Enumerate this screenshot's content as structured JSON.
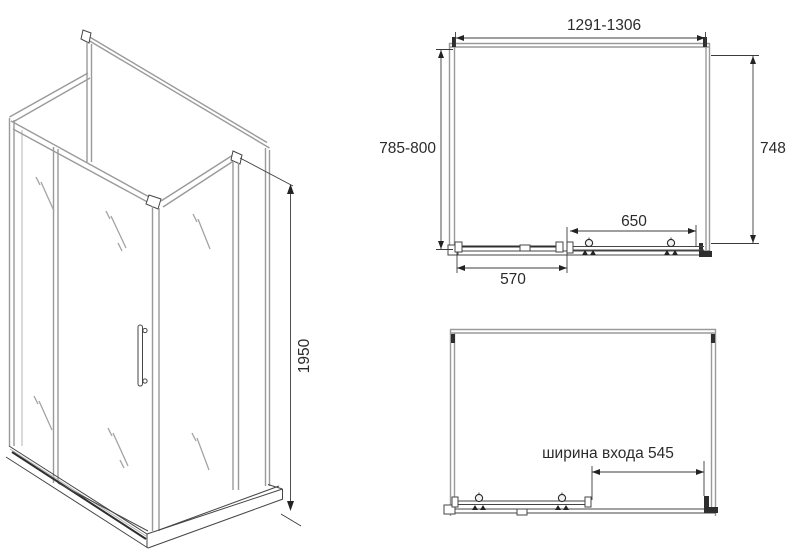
{
  "drawing": {
    "subject": "shower-enclosure-technical-drawing",
    "dimensions": {
      "width_range": "1291-1306",
      "depth_range": "785-800",
      "side_panel_depth": "748",
      "door_panel_width": "650",
      "fixed_panel_width": "570",
      "height": "1950",
      "entrance_width_label": "ширина входа 545"
    },
    "colors": {
      "line": "#454545",
      "profile_gray": "#9a9a9a",
      "text": "#2b2b2b",
      "background": "#ffffff"
    }
  }
}
